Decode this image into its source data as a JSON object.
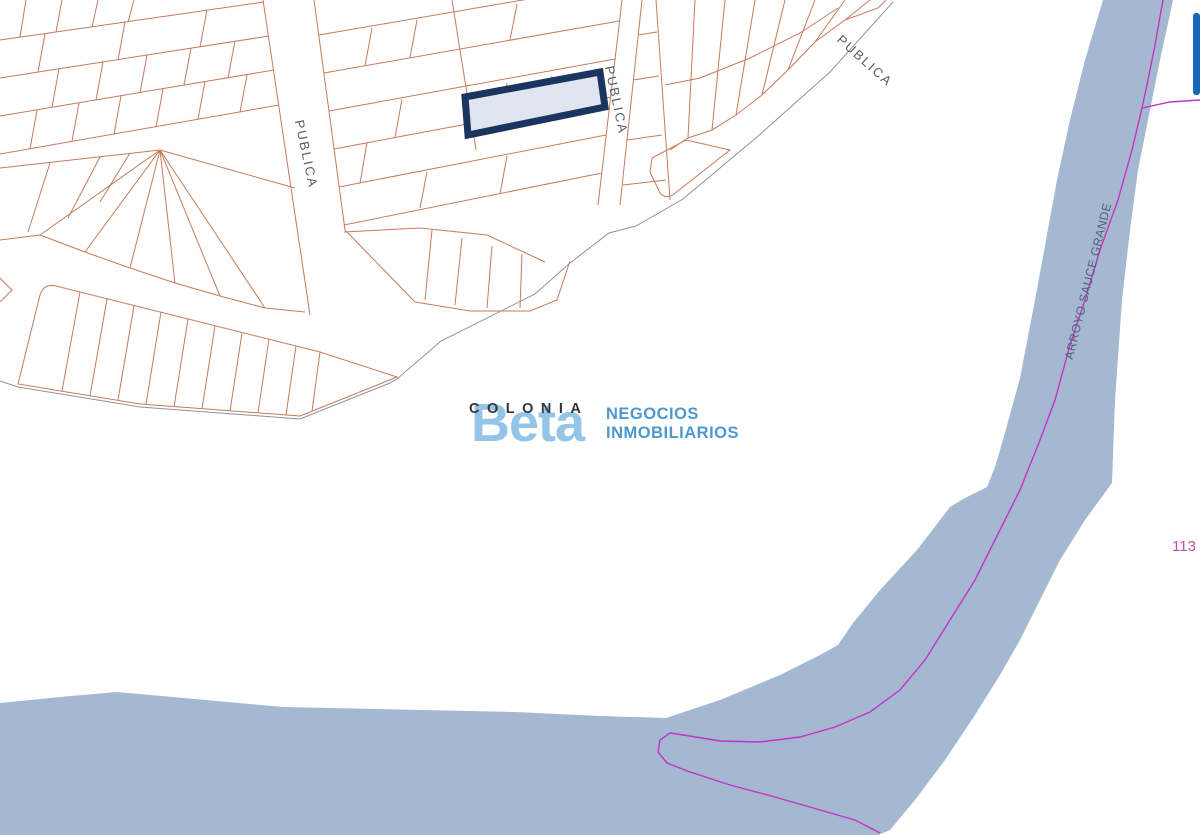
{
  "map": {
    "region_label": {
      "text": "COLONIA"
    },
    "street_labels": [
      {
        "text": "PUBLICA"
      },
      {
        "text": "PUBLICA"
      },
      {
        "text": "PUBLICA"
      }
    ],
    "river_label": {
      "text": "ARROYO SAUCE GRANDE"
    },
    "parcel_ref_number": {
      "text": "113"
    }
  },
  "watermark": {
    "brand": "Beta",
    "tagline_line1": "NEGOCIOS",
    "tagline_line2": "INMOBILIARIOS"
  },
  "colors": {
    "parcel_outline": "#c87a5a",
    "boundary_line": "#8e9299",
    "river_fill": "#a4b8d2",
    "river_centerline": "#c433c4",
    "highlight_fill": "#e0e5ef",
    "highlight_stroke": "#1b3560",
    "edge_marker": "#1668b8",
    "brand_blue": "#8fc2e8",
    "tagline_blue": "#4f97cf",
    "label_gray": "#5a5f66",
    "river_label_color": "#53617a",
    "region_label_color": "#33363b",
    "ref_number_color": "#c44da6"
  }
}
